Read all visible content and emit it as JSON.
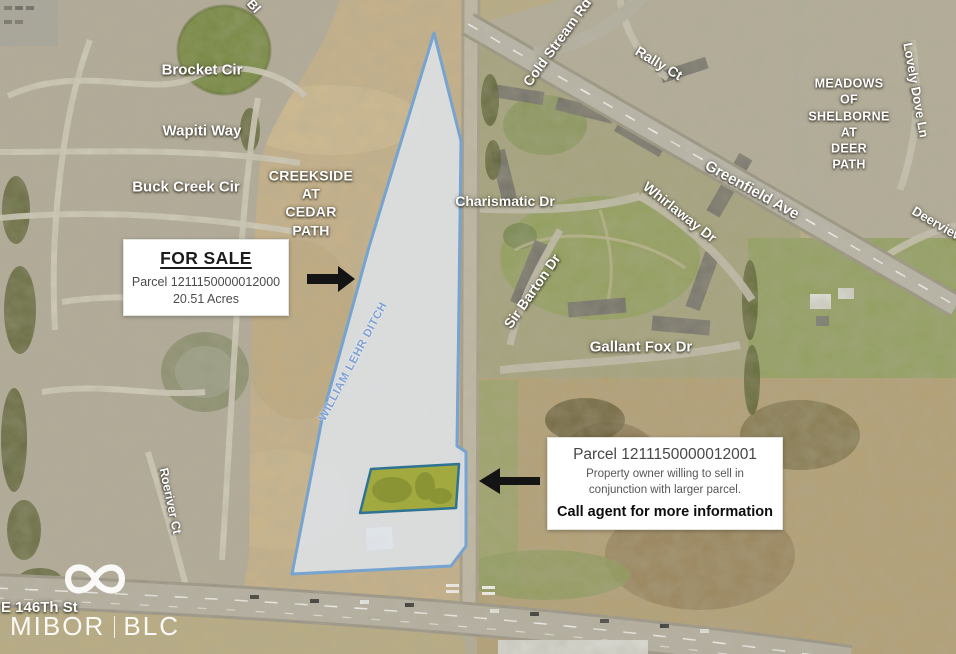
{
  "map": {
    "streets": {
      "brocket": "Brocket Cir",
      "wapiti": "Wapiti Way",
      "buck_creek": "Buck Creek Cir",
      "charismatic": "Charismatic Dr",
      "cold_stream": "Cold Stream Rd",
      "rally": "Rally Ct",
      "whirlaway": "Whirlaway Dr",
      "greenfield": "Greenfield Ave",
      "lovely_dove": "Lovely Dove Ln",
      "deerview": "Deerview",
      "sir_barton": "Sir Barton Dr",
      "gallant_fox": "Gallant Fox Dr",
      "roeriver": "Roeriver Ct",
      "e_146th": "E 146Th St",
      "partial_top": "Bl"
    },
    "neighborhoods": {
      "creekside_lines": [
        "CREEKSIDE",
        "AT",
        "CEDAR",
        "PATH"
      ],
      "meadows_lines": [
        "MEADOWS",
        "OF",
        "SHELBORNE",
        "AT",
        "DEER",
        "PATH"
      ]
    },
    "waterway": "WILLIAM LEHR DITCH"
  },
  "sale_box": {
    "title": "FOR SALE",
    "parcel": "Parcel 1211150000012000",
    "acreage": "20.51 Acres"
  },
  "info_box": {
    "parcel": "Parcel 1211150000012001",
    "note": "Property owner willing to sell in conjunction with larger parcel.",
    "cta": "Call agent for more information"
  },
  "logo": {
    "left": "MIBOR",
    "right": "BLC"
  },
  "colors": {
    "parcel_fill": "rgba(223,229,238,0.82)",
    "parcel_outline": "#76a3cf",
    "small_parcel_fill": "#a2a93e",
    "small_parcel_outline": "#2f7392",
    "arrow": "#141414",
    "ditch_text": "#7fa0d2"
  }
}
